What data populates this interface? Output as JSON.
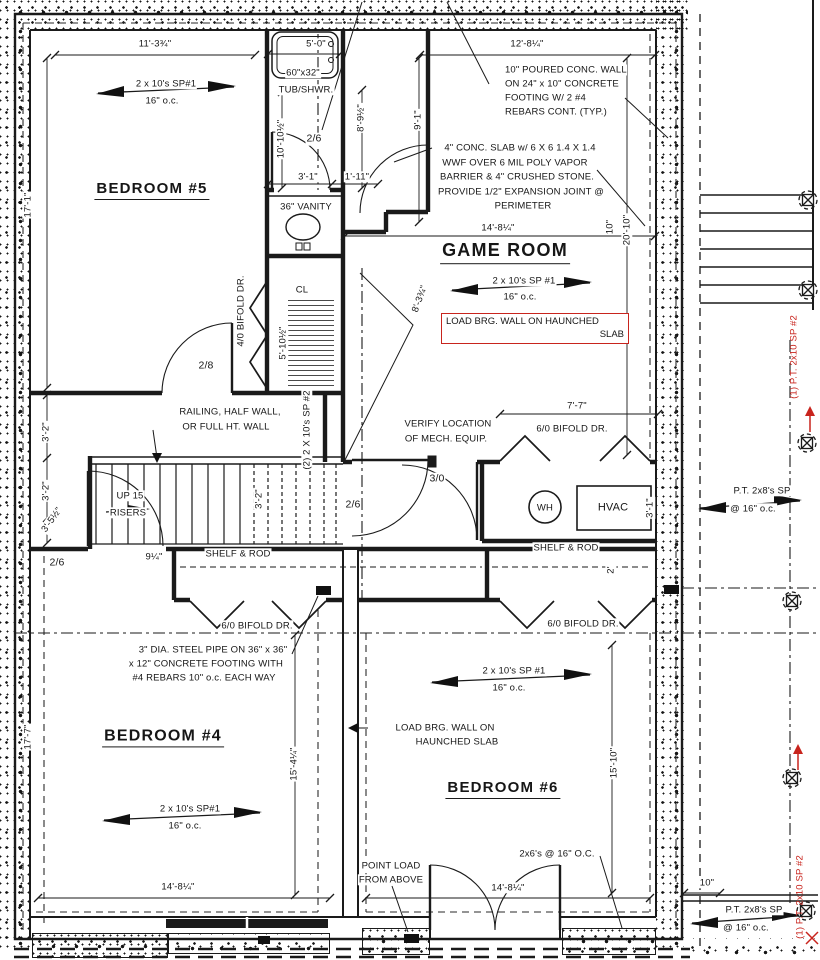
{
  "colors": {
    "ink": "#1a1a1a",
    "red": "#c8241d",
    "paper": "#ffffff"
  },
  "rooms": {
    "bedroom5": "BEDROOM #5",
    "game": "GAME ROOM",
    "bedroom4": "BEDROOM #4",
    "bedroom6": "BEDROOM #6",
    "closet": "CL"
  },
  "fixtures": {
    "tub_size": "60\"x32\"",
    "tub": "TUB/SHWR.",
    "vanity": "36\" VANITY",
    "wh": "WH",
    "hvac": "HVAC"
  },
  "doors": {
    "bath": "2/6",
    "bed5": "2/8",
    "hall": "2/6",
    "bed4": "2/6",
    "mech": "3/0",
    "bifold_cl": "4/0 BIFOLD DR.",
    "bifold_mech": "6/0 BIFOLD DR.",
    "bifold_left": "6/0 BIFOLD DR.",
    "bifold_right": "6/0 BIFOLD DR."
  },
  "framing": {
    "b5": [
      "2 x 10's SP#1",
      "16\" o.c."
    ],
    "game": [
      "2 x 10's SP #1",
      "16\" o.c."
    ],
    "b4": [
      "2 x 10's SP#1",
      "16\" o.c."
    ],
    "b6": [
      "2 x 10's SP #1",
      "16\" o.c."
    ],
    "stair": "(2) 2 X 10's SP #2",
    "ceiling_2x6": "2x6's @ 16\" O.C.",
    "pt_mid": [
      "P.T. 2x8's SP",
      "@ 16\" o.c."
    ],
    "pt_bot": [
      "P.T. 2x8's SP",
      "@ 16\" o.c."
    ],
    "pt_red_mid": "(1) P.T. 2x10 SP #2",
    "pt_red_bot": "(1) P.T. 2x10 SP #2"
  },
  "dims": {
    "w_b5": "11'-3¾\"",
    "w_bath": "5'-0\"",
    "w_game_top": "12'-8¼\"",
    "h_b5": "17'-1\"",
    "h_bath": "10'-10½\"",
    "h_chase": "8'-9½\"",
    "w_door_nook": "3'-1\"",
    "w_nook": "1'-11\"",
    "h_game_l": "9'-1\"",
    "w_game": "14'-8¼\"",
    "h_game": "20'-10\"",
    "wall_10a": "10\"",
    "diag_hall": "8'-3¾\"",
    "h_closet": "5'-10½\"",
    "stair_a": "3'-2\"",
    "stair_b": "3'-2\"",
    "stair_c": "3'-5½\"",
    "stair_d": "3'-2\"",
    "w_mech": "7'-7\"",
    "d_hvac": "3'-1\"",
    "shelf_r_d": "2'",
    "shelf_l_d": "9¼\"",
    "h_b4": "17'-7\"",
    "h_b4_r": "15'-4¼\"",
    "w_b4": "14'-8¼\"",
    "h_b6": "15'-10\"",
    "w_b6": "14'-8¼\"",
    "deck_10": "10\""
  },
  "notes": {
    "wall": [
      "10\" POURED CONC. WALL",
      "ON 24\" x 10\" CONCRETE",
      "FOOTING W/ 2 #4",
      "REBARS CONT. (TYP.)"
    ],
    "slab": [
      "4\" CONC. SLAB w/ 6 X 6 1.4 X 1.4",
      "WWF OVER 6 MIL POLY VAPOR",
      "BARRIER & 4\" CRUSHED STONE.",
      "PROVIDE 1/2\" EXPANSION JOINT @",
      "PERIMETER"
    ],
    "load_wall_boxed": [
      "LOAD BRG. WALL ON HAUNCHED",
      "SLAB"
    ],
    "load_wall": [
      "LOAD BRG. WALL ON",
      "HAUNCHED SLAB"
    ],
    "railing": [
      "RAILING, HALF WALL,",
      "OR FULL HT. WALL"
    ],
    "verify": [
      "VERIFY LOCATION",
      "OF MECH. EQUIP."
    ],
    "pipe": [
      "3\" DIA. STEEL PIPE ON 36\" x 36\"",
      "x 12\" CONCRETE FOOTING WITH",
      "#4 REBARS 10\" o.c. EACH WAY"
    ],
    "point_load": [
      "POINT LOAD",
      "FROM ABOVE"
    ],
    "up": [
      "UP 15",
      "RISERS"
    ],
    "shelf_rod_left": "SHELF & ROD",
    "shelf_rod_right": "SHELF & ROD"
  }
}
